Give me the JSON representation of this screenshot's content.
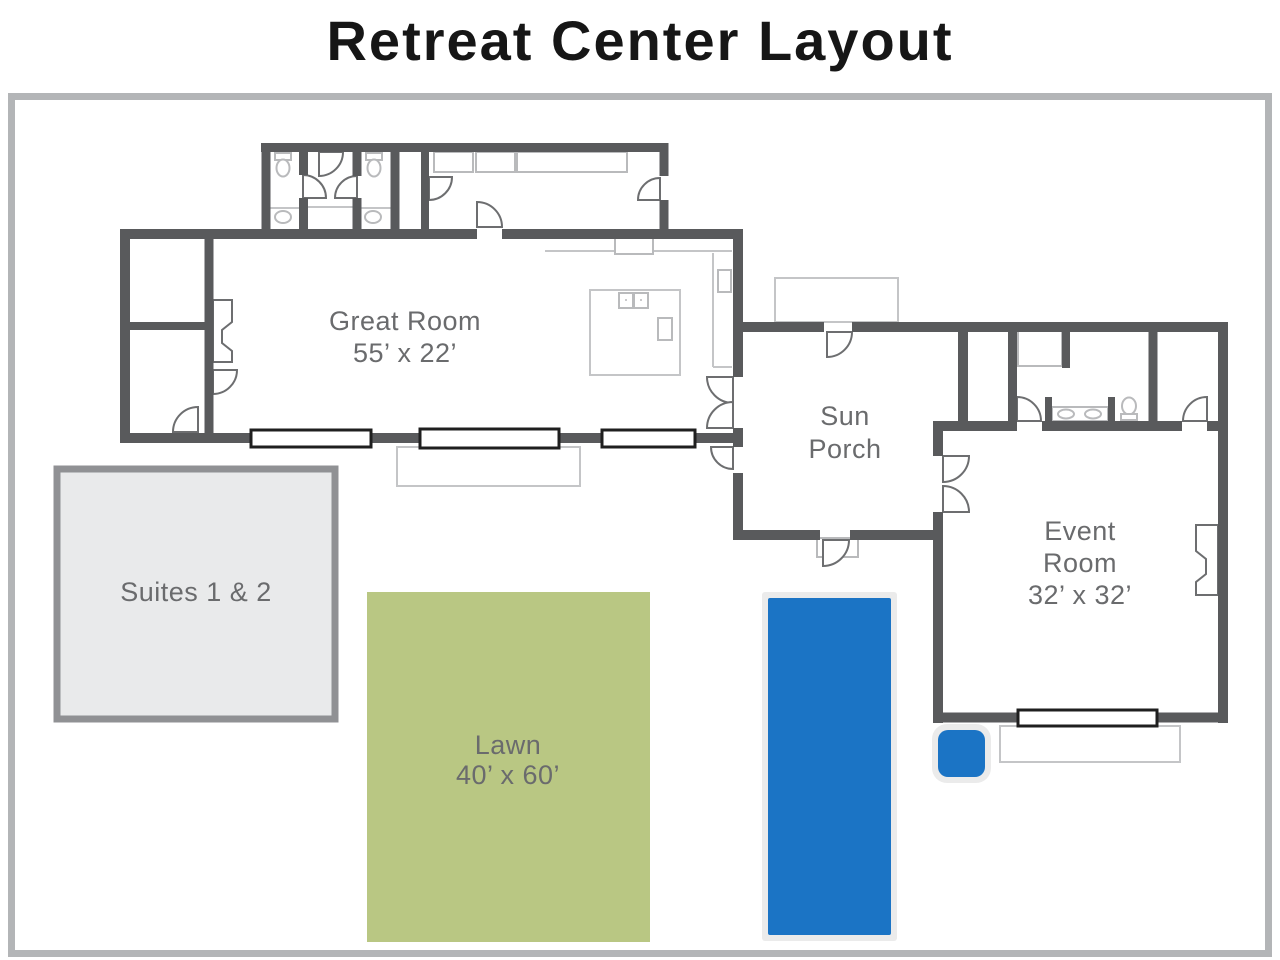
{
  "title": "Retreat Center Layout",
  "rooms": {
    "great_room": {
      "lines": [
        "Great Room",
        "55’ x 22’"
      ]
    },
    "sun_porch": {
      "lines": [
        "Sun",
        "Porch"
      ]
    },
    "event_room": {
      "lines": [
        "Event",
        "Room",
        "32’ x 32’"
      ]
    },
    "suites": {
      "lines": [
        "Suites 1 & 2"
      ]
    },
    "lawn": {
      "lines": [
        "Lawn",
        "40’ x 60’"
      ]
    }
  },
  "colors": {
    "wall": "#595a5c",
    "label_gray": "#6a6b6d",
    "lawn_green": "#b9c783",
    "water_blue": "#1b74c5",
    "suites_fill": "#e9eaeb",
    "suites_border": "#909194",
    "frame_border": "#b3b5b7",
    "fixture_gray": "#b9babc",
    "title_black": "#161616"
  }
}
